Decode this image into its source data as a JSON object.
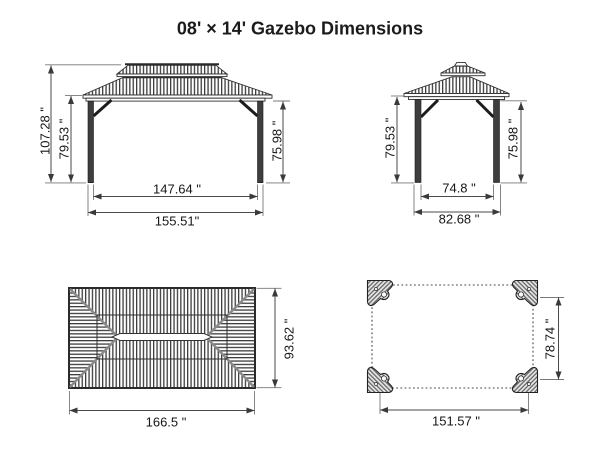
{
  "title": "08' × 14' Gazebo Dimensions",
  "accent_color": "#1b1b1b",
  "front_view": {
    "height_total": "107.28 \"",
    "height_post": "79.53 \"",
    "height_clear": "75.98 \"",
    "width_inner": "147.64 \"",
    "width_outer": "155.51\""
  },
  "side_view": {
    "height_post": "79.53 \"",
    "height_clear": "75.98 \"",
    "width_inner": "74.8 \"",
    "width_outer": "82.68 \""
  },
  "roof_plan": {
    "width": "166.5 \"",
    "depth": "93.62 \""
  },
  "base_plan": {
    "width": "151.57 \"",
    "depth": "78.74 \""
  }
}
